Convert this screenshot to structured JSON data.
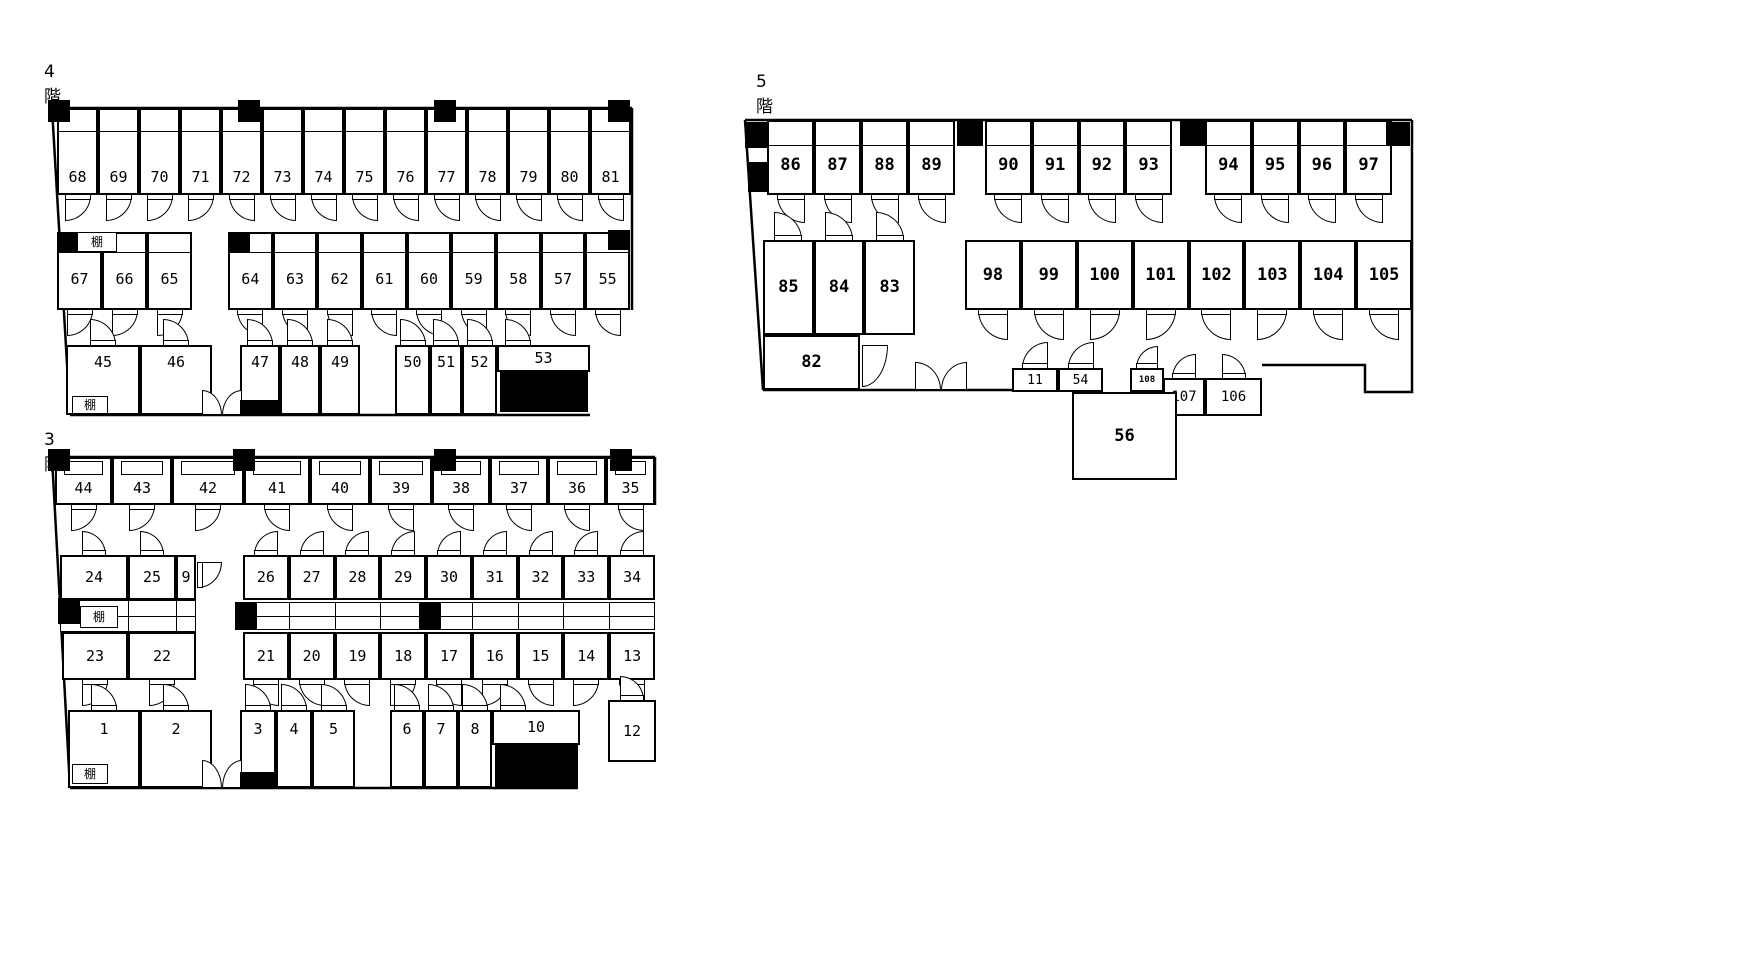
{
  "floors": {
    "f4": {
      "label": "4階",
      "shelves": {
        "mid": "棚",
        "bottom": "棚"
      },
      "rows": {
        "top": [
          "68",
          "69",
          "70",
          "71",
          "72",
          "73",
          "74",
          "75",
          "76",
          "77",
          "78",
          "79",
          "80",
          "81"
        ],
        "mid_left": [
          "67",
          "66",
          "65"
        ],
        "mid_right": [
          "64",
          "63",
          "62",
          "61",
          "60",
          "59",
          "58",
          "57",
          "55"
        ],
        "bottom_a": [
          "45",
          "46"
        ],
        "bottom_b": [
          "47",
          "48",
          "49"
        ],
        "bottom_c": [
          "50",
          "51",
          "52"
        ],
        "bottom_d": [
          "53"
        ]
      }
    },
    "f3": {
      "label": "3階",
      "shelves": {
        "mid": "棚",
        "bottom": "棚"
      },
      "rows": {
        "top": [
          "44",
          "43",
          "42",
          "41",
          "40",
          "39",
          "38",
          "37",
          "36",
          "35"
        ],
        "mid_upper_left": [
          "24",
          "25",
          "9"
        ],
        "mid_upper_right": [
          "26",
          "27",
          "28",
          "29",
          "30",
          "31",
          "32",
          "33",
          "34"
        ],
        "mid_lower_left": [
          "23",
          "22"
        ],
        "mid_lower_right": [
          "21",
          "20",
          "19",
          "18",
          "17",
          "16",
          "15",
          "14",
          "13"
        ],
        "bottom_a": [
          "1",
          "2"
        ],
        "bottom_b": [
          "3",
          "4",
          "5"
        ],
        "bottom_c": [
          "6",
          "7",
          "8"
        ],
        "bottom_d": [
          "10"
        ],
        "room_12": [
          "12"
        ]
      }
    },
    "f5": {
      "label": "5階",
      "rows": {
        "top_a": [
          "86",
          "87",
          "88",
          "89"
        ],
        "top_b": [
          "90",
          "91",
          "92",
          "93"
        ],
        "top_c": [
          "94",
          "95",
          "96",
          "97"
        ],
        "mid_left": [
          "85",
          "84",
          "83"
        ],
        "mid_right": [
          "98",
          "99",
          "100",
          "101",
          "102",
          "103",
          "104",
          "105"
        ],
        "room_82": [
          "82"
        ],
        "small_a": [
          "11",
          "54"
        ],
        "small_b": [
          "108"
        ],
        "small_c": [
          "107",
          "106"
        ],
        "room_56": [
          "56"
        ]
      }
    }
  },
  "colors": {
    "wall": "#000000",
    "background": "#ffffff",
    "fill": "#000000"
  }
}
